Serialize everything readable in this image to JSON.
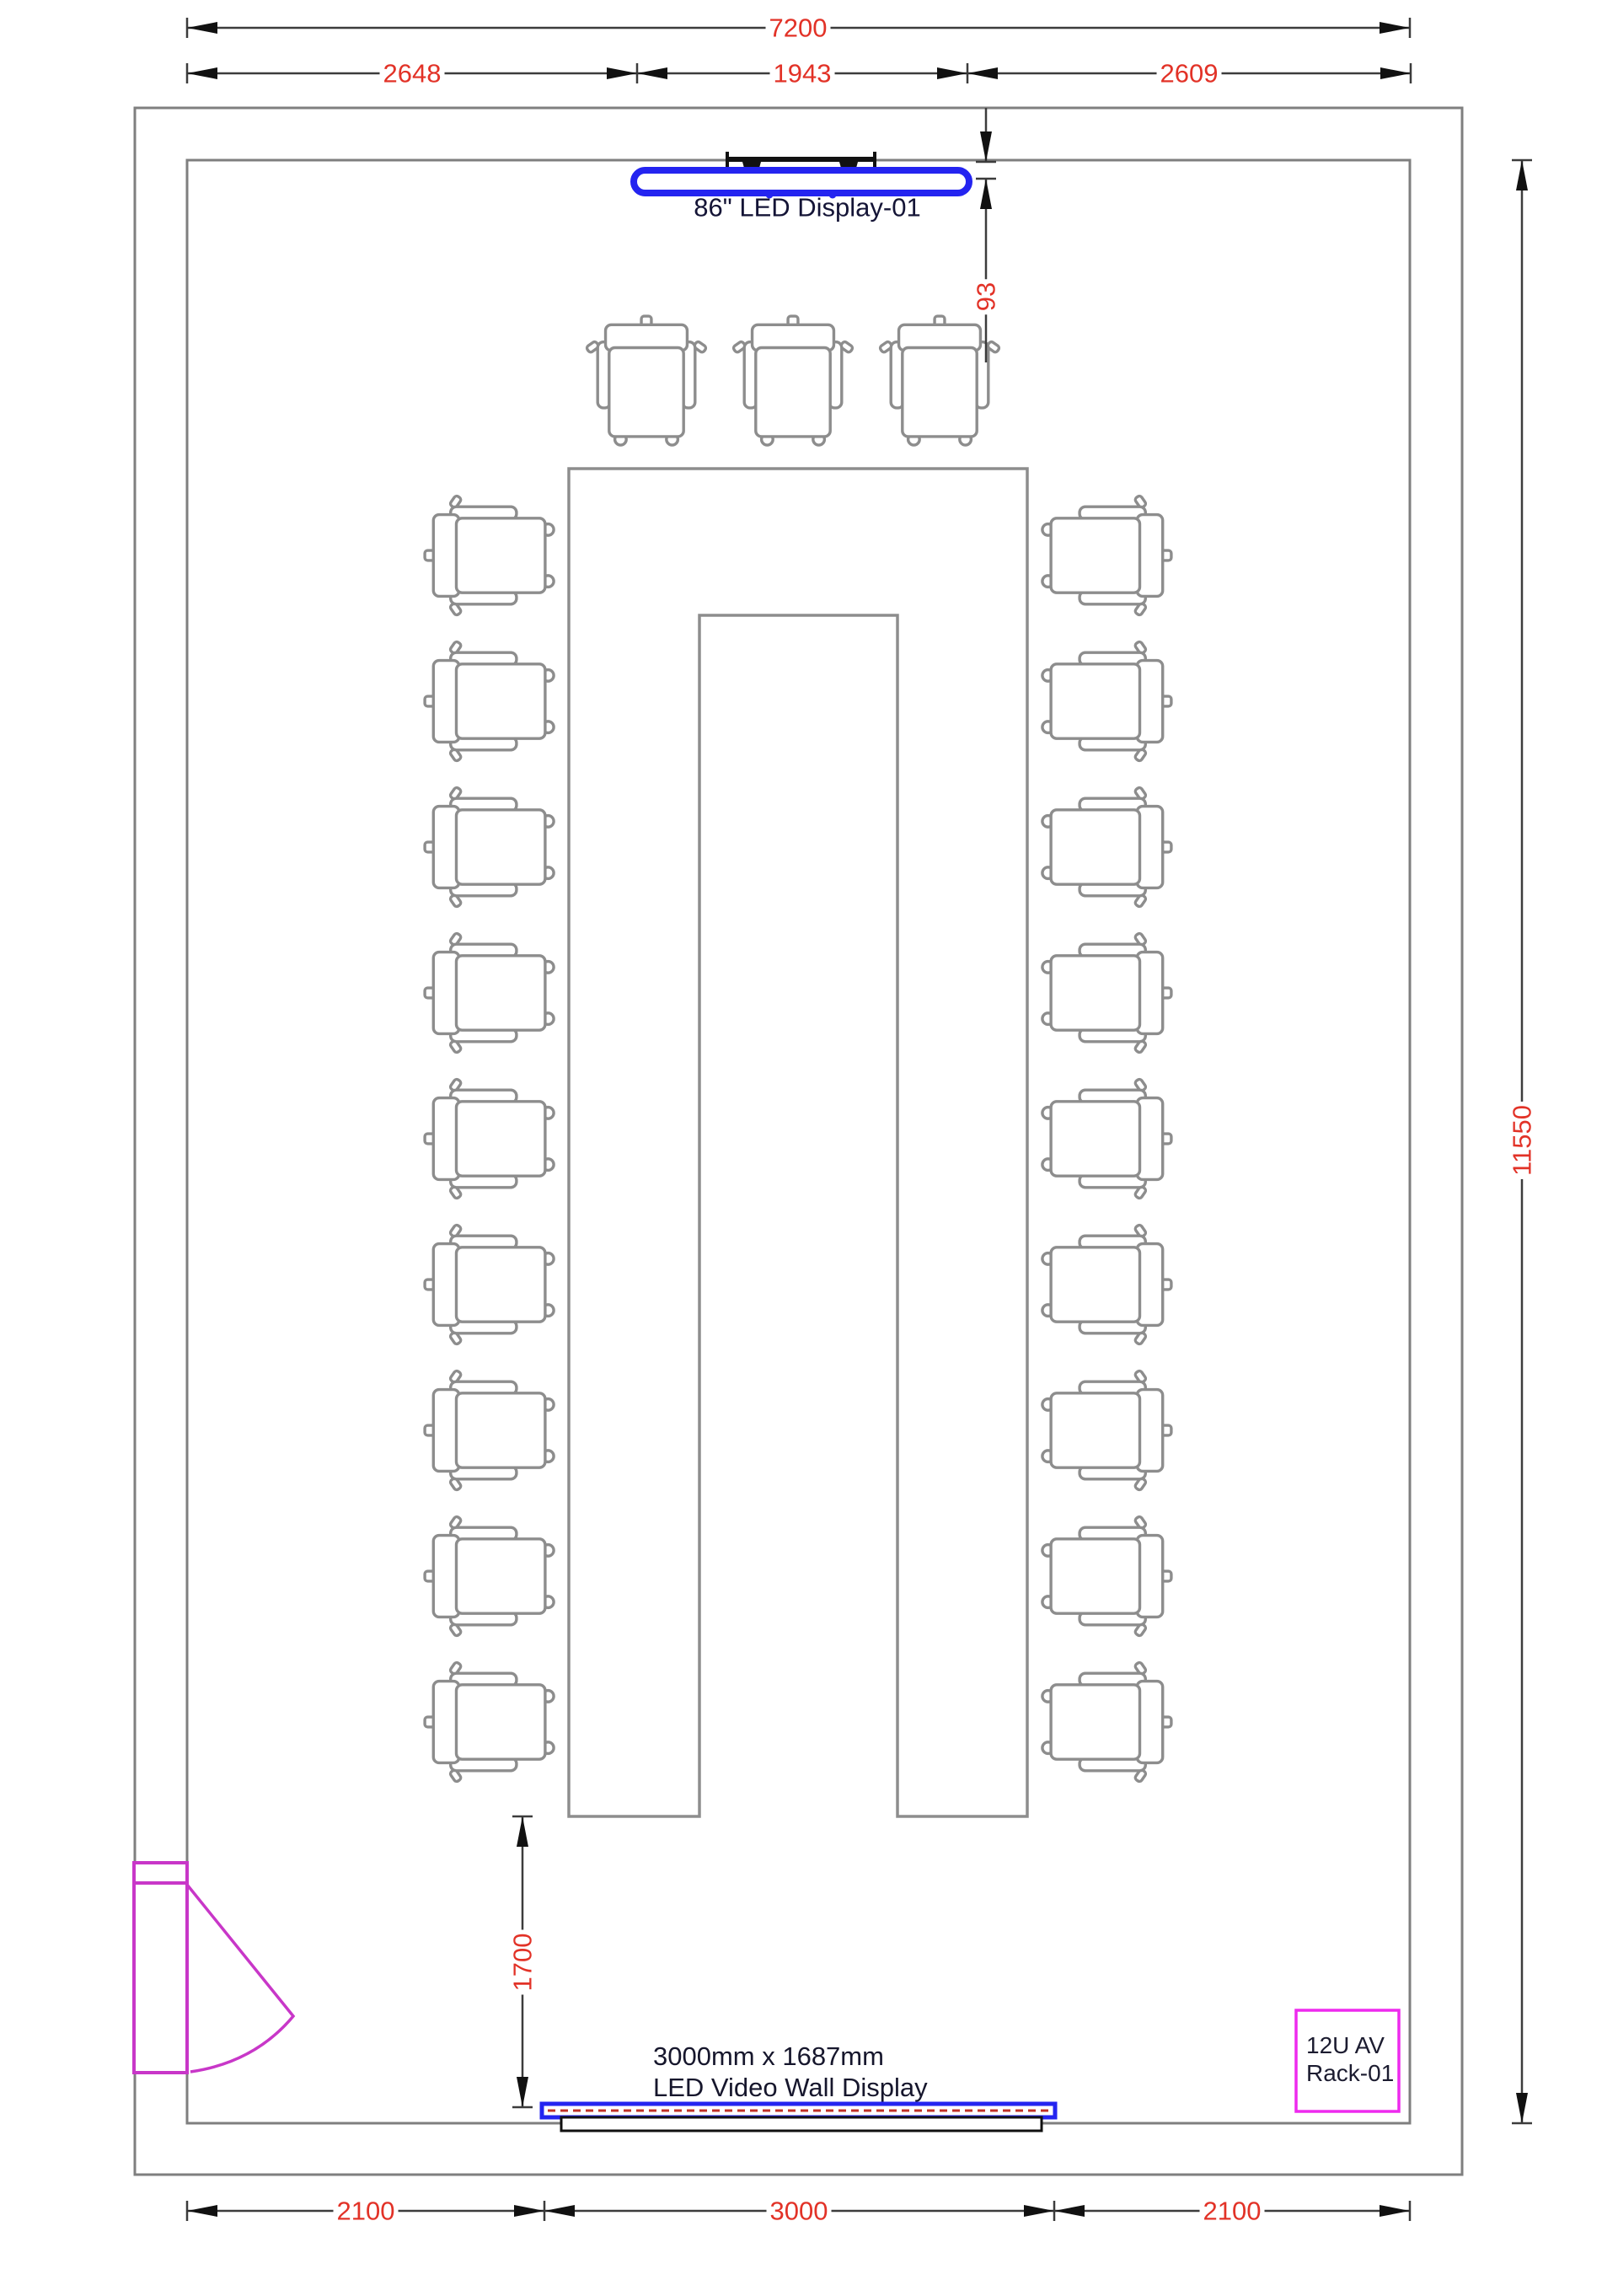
{
  "drawing": {
    "title": "Conference room AV floor plan",
    "display_label": "86\" LED Display-01",
    "video_wall_label_line1": "3000mm x 1687mm",
    "video_wall_label_line2": "LED Video Wall Display",
    "rack_label_line1": "12U AV",
    "rack_label_line2": "Rack-01",
    "chair_count_top": 3,
    "chair_count_left": 9,
    "chair_count_right": 9
  },
  "dimensions": {
    "room_width_total": "7200",
    "top_left_segment": "2648",
    "top_middle_segment": "1943",
    "top_right_segment": "2609",
    "display_wall_gap": "93",
    "room_height_total": "11550",
    "table_to_videowall": "1700",
    "bottom_left_segment": "2100",
    "bottom_middle_segment": "3000",
    "bottom_right_segment": "2100"
  },
  "colors": {
    "dimension_text_red": "#e23227",
    "dimension_line": "#3c3c3c",
    "wall_gray": "#7f7f7f",
    "furniture_gray": "#8d8d8d",
    "display_blue": "#2424f0",
    "videowall_dash_red": "#c03028",
    "door_magenta": "#c837c8",
    "rack_magenta": "#ee2aee",
    "label_navy": "#141436"
  }
}
